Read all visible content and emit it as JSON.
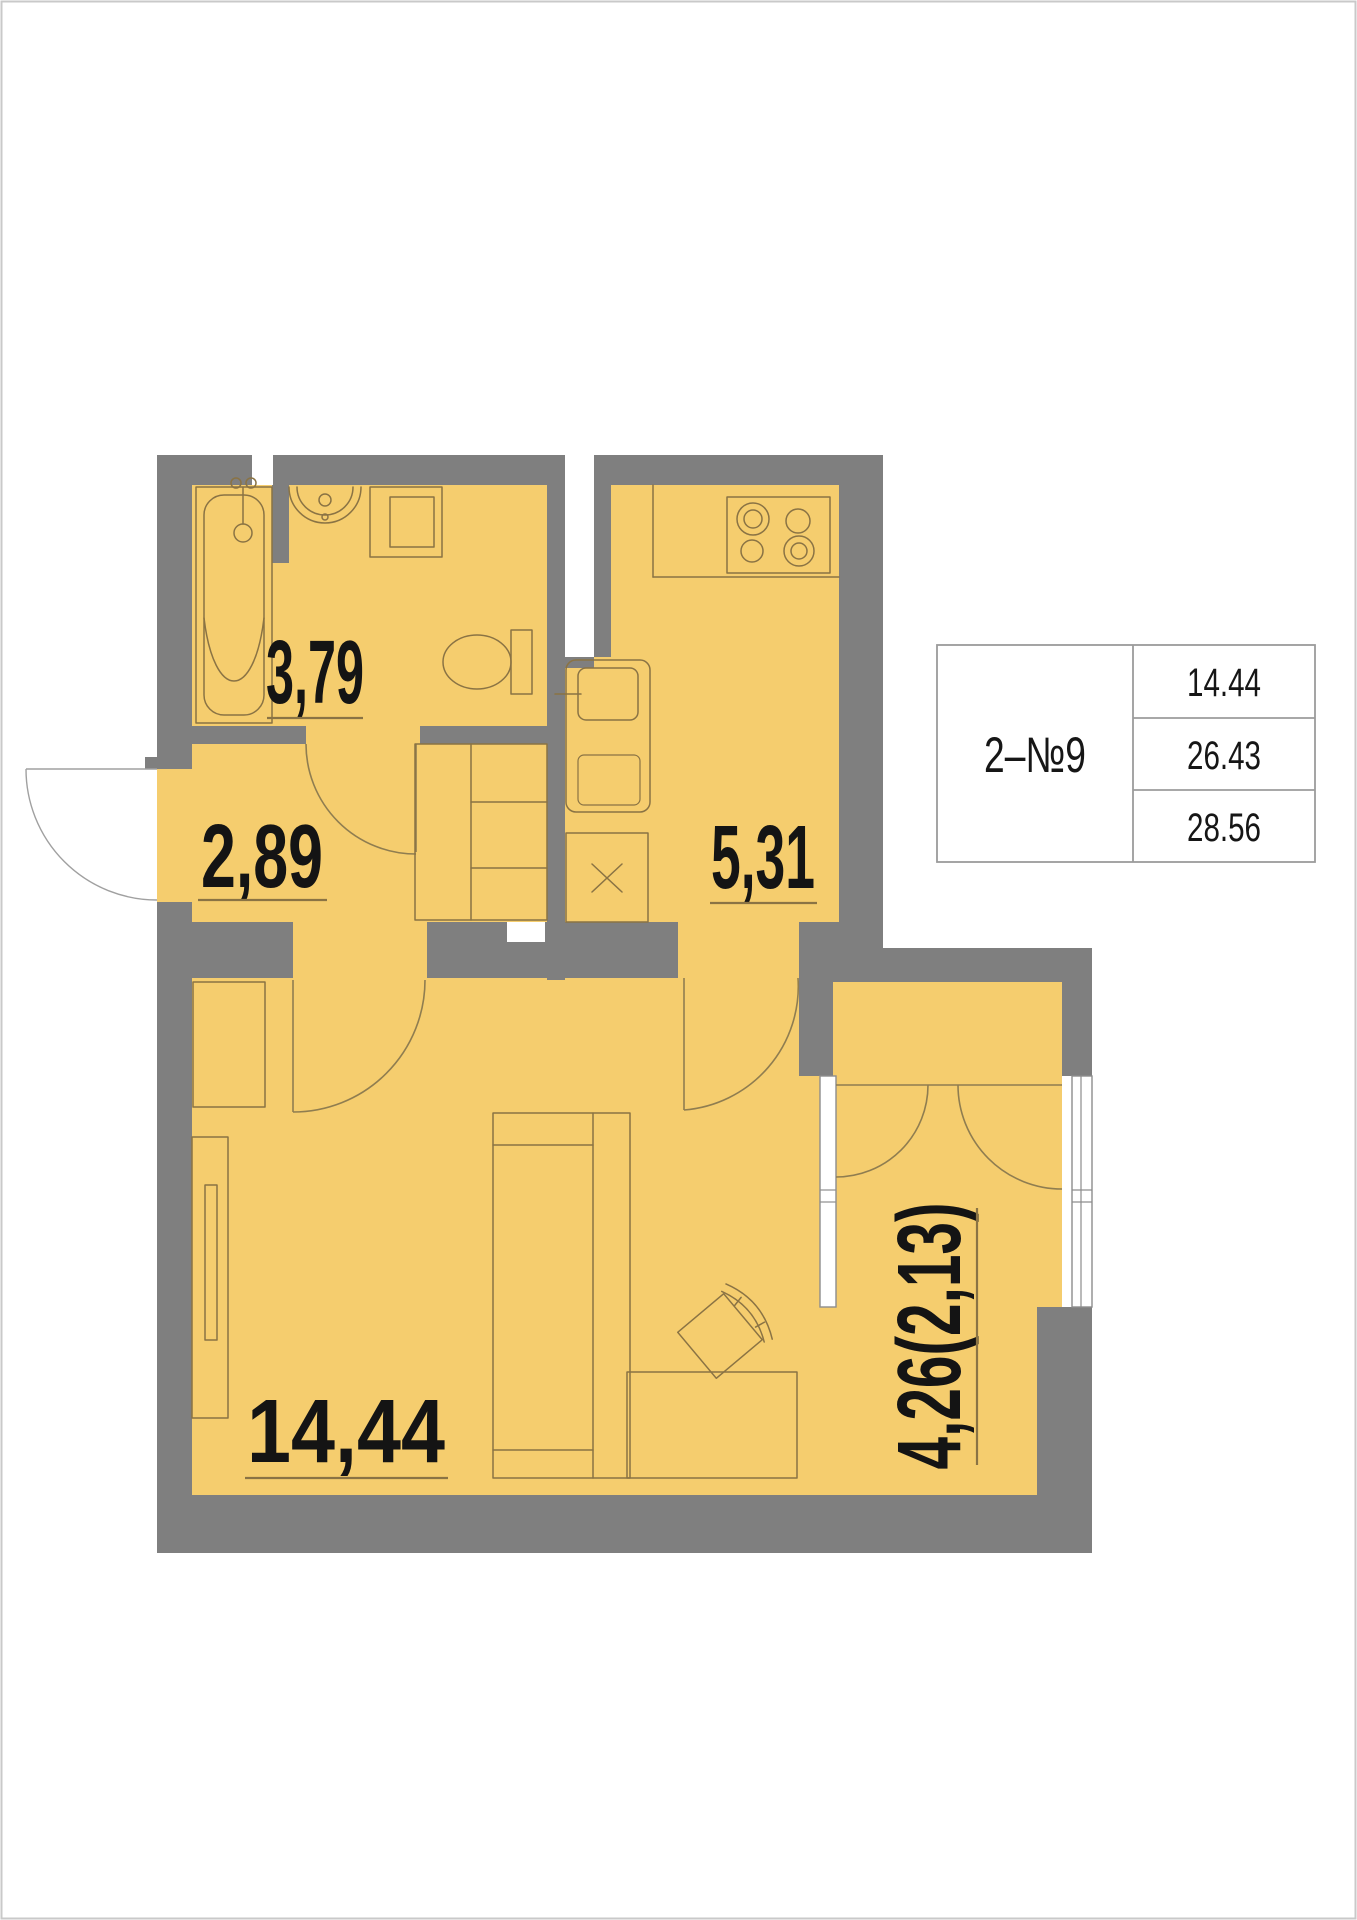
{
  "colors": {
    "floor": "#f5cd6e",
    "wall": "#7f7f7f",
    "fixture": "#8a7344",
    "door_arc": "#8f7d50",
    "label": "#141414",
    "underline": "#8a7344",
    "table_border": "#9b9b9b",
    "page_border": "#c9c9c9"
  },
  "rooms": {
    "bathroom": {
      "label": "3,79"
    },
    "hallway": {
      "label": "2,89"
    },
    "kitchen": {
      "label": "5,31"
    },
    "living": {
      "label": "14,44"
    },
    "balcony": {
      "label": "4,26(2,13)"
    }
  },
  "info_table": {
    "unit_label": "2–№9",
    "rows": [
      {
        "value": "14.44"
      },
      {
        "value": "26.43"
      },
      {
        "value": "28.56"
      }
    ]
  }
}
